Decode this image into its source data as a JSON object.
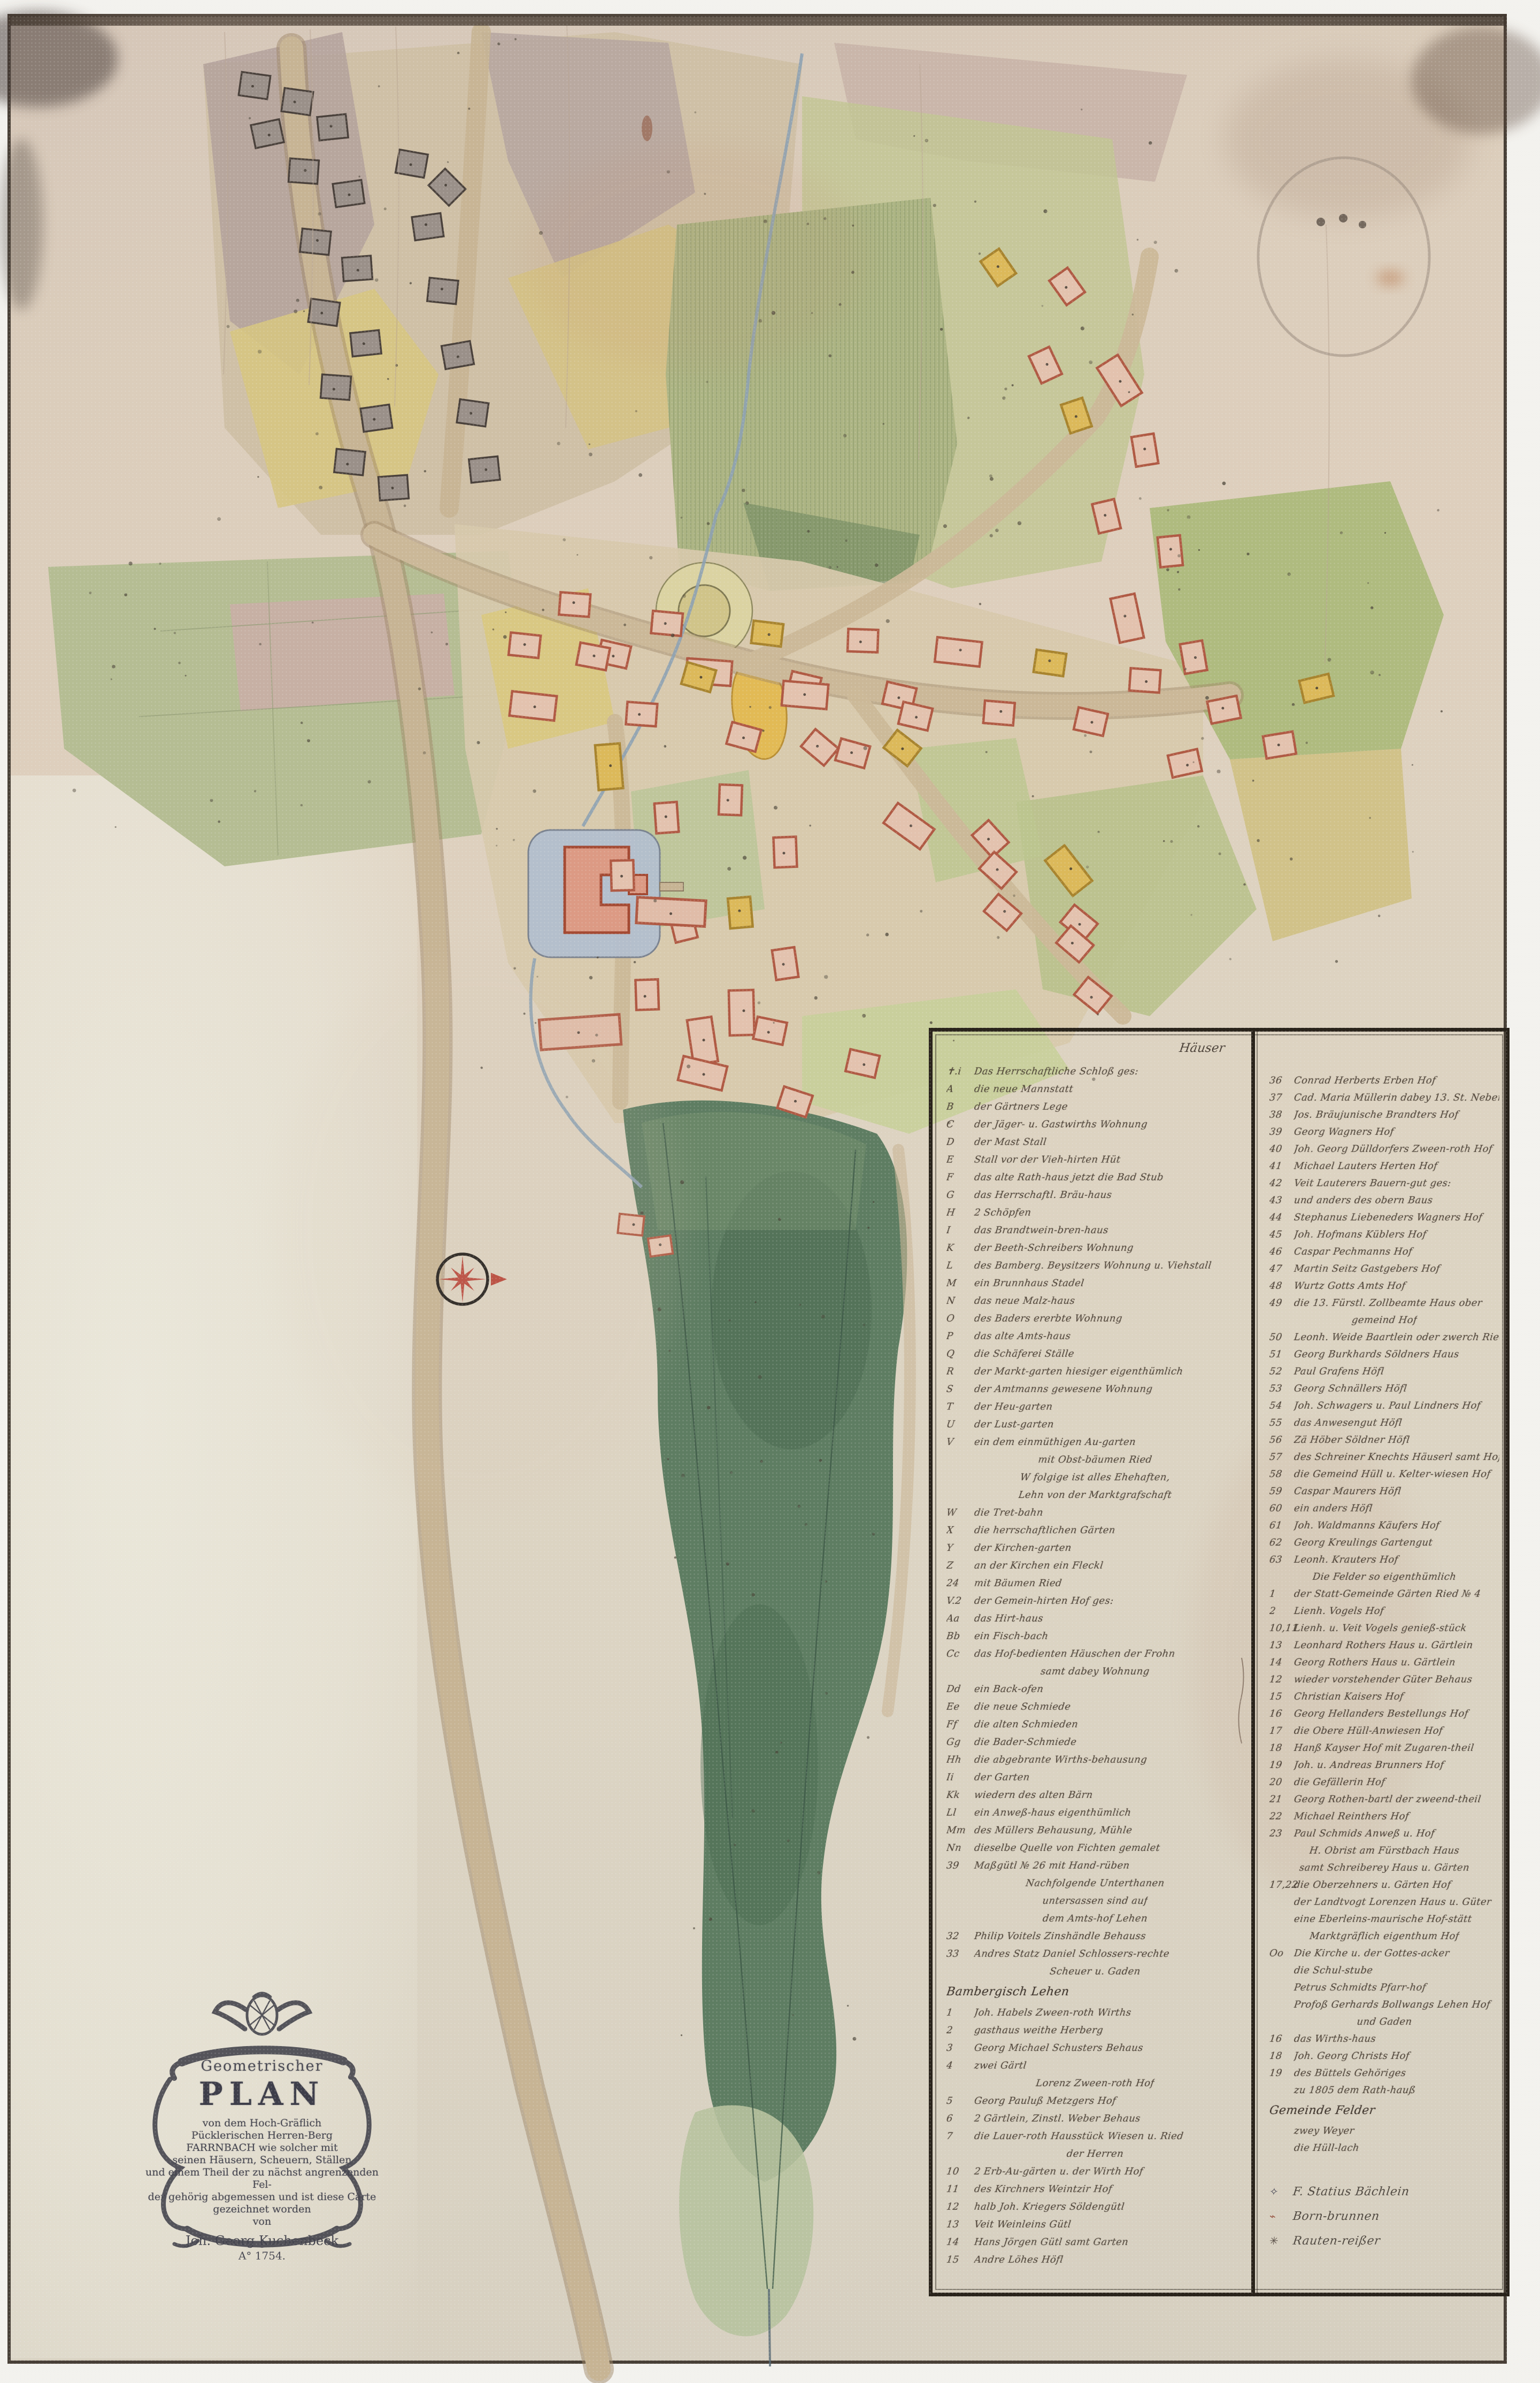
{
  "cartouche": {
    "kicker": "Geometrischer",
    "title": "PLAN",
    "lines": [
      "von dem Hoch-Gräflich",
      "Pücklerischen Herren-Berg",
      "FARRNBACH wie solcher mit",
      "seinen Häusern, Scheuern, Ställen",
      "und einem Theil der zu nächst angrenzenden Fel-",
      "der gehörig abgemessen und ist diese Carte",
      "gezeichnet worden",
      "von"
    ],
    "author": "Joh. Georg Kuchenbeck",
    "year": "A° 1754."
  },
  "legend": {
    "header_right": "Häuser",
    "col1": [
      {
        "k": "✝.i",
        "t": "Das Herrschaftliche Schloß ges:"
      },
      {
        "k": "A",
        "t": "die neue Mannstatt"
      },
      {
        "k": "B",
        "t": "der Gärtners Lege"
      },
      {
        "k": "C",
        "t": "der Jäger- u. Gastwirths Wohnung"
      },
      {
        "k": "D",
        "t": "der Mast Stall"
      },
      {
        "k": "E",
        "t": "Stall vor der Vieh-hirten Hüt"
      },
      {
        "k": "F",
        "t": "das alte Rath-haus jetzt die Bad Stub"
      },
      {
        "k": "G",
        "t": "das Herrschaftl. Bräu-haus"
      },
      {
        "k": "H",
        "t": "2 Schöpfen"
      },
      {
        "k": "I",
        "t": "das Brandtwein-bren-haus"
      },
      {
        "k": "K",
        "t": "der Beeth-Schreibers Wohnung"
      },
      {
        "k": "L",
        "t": "des Bamberg. Beysitzers Wohnung u. Viehstall"
      },
      {
        "k": "M",
        "t": "ein Brunnhaus Stadel"
      },
      {
        "k": "N",
        "t": "das neue Malz-haus"
      },
      {
        "k": "O",
        "t": "des Baders ererbte Wohnung"
      },
      {
        "k": "P",
        "t": "das alte Amts-haus"
      },
      {
        "k": "Q",
        "t": "die Schäferei Ställe"
      },
      {
        "k": "R",
        "t": "der Markt-garten hiesiger eigenthümlich"
      },
      {
        "k": "S",
        "t": "der Amtmanns gewesene Wohnung"
      },
      {
        "k": "T",
        "t": "der Heu-garten"
      },
      {
        "k": "U",
        "t": "der Lust-garten"
      },
      {
        "k": "V",
        "t": "ein dem einmüthigen Au-garten"
      },
      {
        "c": "mit Obst-bäumen Ried"
      },
      {
        "c": "W folgige ist alles Ehehaften,"
      },
      {
        "c": "Lehn von der Marktgrafschaft"
      },
      {
        "k": "W",
        "t": "die Tret-bahn"
      },
      {
        "k": "X",
        "t": "die herrschaftlichen Gärten"
      },
      {
        "k": "Y",
        "t": "der Kirchen-garten"
      },
      {
        "k": "Z",
        "t": "an der Kirchen ein Fleckl"
      },
      {
        "k": "24",
        "t": "mit Bäumen Ried"
      },
      {
        "k": "V.2",
        "t": "der Gemein-hirten Hof ges:"
      },
      {
        "k": "Aa",
        "t": "das Hirt-haus"
      },
      {
        "k": "Bb",
        "t": "ein Fisch-bach"
      },
      {
        "k": "Cc",
        "t": "das Hof-bedienten Häuschen der Frohn"
      },
      {
        "c": "samt dabey Wohnung"
      },
      {
        "k": "Dd",
        "t": "ein Back-ofen"
      },
      {
        "k": "Ee",
        "t": "die neue Schmiede"
      },
      {
        "k": "Ff",
        "t": "die alten Schmieden"
      },
      {
        "k": "Gg",
        "t": "die Bader-Schmiede"
      },
      {
        "k": "Hh",
        "t": "die abgebrante Wirths-behausung"
      },
      {
        "k": "Ii",
        "t": "der Garten"
      },
      {
        "k": "Kk",
        "t": "wiedern des alten Bärn"
      },
      {
        "k": "Ll",
        "t": "ein Anweß-haus eigenthümlich"
      },
      {
        "k": "Mm",
        "t": "des Müllers Behausung, Mühle"
      },
      {
        "k": "Nn",
        "t": "dieselbe Quelle von Fichten gemalet"
      },
      {
        "k": "39",
        "t": "Maßgütl № 26 mit Hand-rüben"
      },
      {
        "c": "Nachfolgende Unterthanen"
      },
      {
        "c": "untersassen sind auf"
      },
      {
        "c": "dem Amts-hof Lehen"
      },
      {
        "k": "32",
        "t": "Philip Voitels Zinshändle Behauss"
      },
      {
        "k": "33",
        "t": "Andres Statz Daniel Schlossers-rechte"
      },
      {
        "c": "Scheuer u. Gaden"
      },
      {
        "h": "Bambergisch Lehen"
      },
      {
        "k": "1",
        "t": "Joh. Habels Zween-roth Wirths"
      },
      {
        "k": "2",
        "t": "gasthaus weithe Herberg"
      },
      {
        "k": "3",
        "t": "Georg Michael Schusters Behaus"
      },
      {
        "k": "4",
        "t": "zwei Gärtl"
      },
      {
        "c": "Lorenz Zween-roth Hof"
      },
      {
        "k": "5",
        "t": "Georg Pauluß Metzgers Hof"
      },
      {
        "k": "6",
        "t": "2 Gärtlein, Zinstl. Weber Behaus"
      },
      {
        "k": "7",
        "t": "die Lauer-roth Hausstück Wiesen u. Ried"
      },
      {
        "c": "der Herren"
      },
      {
        "k": "10",
        "t": "2 Erb-Au-gärten u. der Wirth Hof"
      },
      {
        "k": "11",
        "t": "des Kirchners Weintzir Hof"
      },
      {
        "k": "12",
        "t": "halb Joh. Kriegers Söldengütl"
      },
      {
        "k": "13",
        "t": "Veit Weinleins Gütl"
      },
      {
        "k": "14",
        "t": "Hans Jörgen Gütl samt Garten"
      },
      {
        "k": "15",
        "t": "Andre Löhes Höfl"
      }
    ],
    "col2": [
      {
        "k": "36",
        "t": "Conrad Herberts Erben Hof"
      },
      {
        "k": "37",
        "t": "Cad. Maria Müllerin dabey 13. St. Nebenbau"
      },
      {
        "k": "38",
        "t": "Jos. Bräujunische Brandters Hof"
      },
      {
        "k": "39",
        "t": "Georg Wagners Hof"
      },
      {
        "k": "40",
        "t": "Joh. Georg Dülldorfers Zween-roth Hof"
      },
      {
        "k": "41",
        "t": "Michael Lauters Herten Hof"
      },
      {
        "k": "42",
        "t": "Veit Lauterers Bauern-gut ges:"
      },
      {
        "k": "43",
        "t": "und anders des obern Baus"
      },
      {
        "k": "44",
        "t": "Stephanus Liebeneders Wagners Hof"
      },
      {
        "k": "45",
        "t": "Joh. Hofmans Küblers Hof"
      },
      {
        "k": "46",
        "t": "Caspar Pechmanns Hof"
      },
      {
        "k": "47",
        "t": "Martin Seitz Gastgebers Hof"
      },
      {
        "k": "48",
        "t": "Wurtz Gotts Amts Hof"
      },
      {
        "k": "49",
        "t": "die 13. Fürstl. Zollbeamte Haus ober"
      },
      {
        "c": "gemeind Hof"
      },
      {
        "k": "50",
        "t": "Leonh. Weide Baartlein oder zwerch Ried"
      },
      {
        "k": "51",
        "t": "Georg Burkhards Söldners Haus"
      },
      {
        "k": "52",
        "t": "Paul Grafens Höfl"
      },
      {
        "k": "53",
        "t": "Georg Schnällers Höfl"
      },
      {
        "k": "54",
        "t": "Joh. Schwagers u. Paul Lindners Hof"
      },
      {
        "k": "55",
        "t": "das Anwesengut Höfl"
      },
      {
        "k": "56",
        "t": "Zä Höber Söldner Höfl"
      },
      {
        "k": "57",
        "t": "des Schreiner Knechts Häuserl samt Hof"
      },
      {
        "k": "58",
        "t": "die Gemeind Hüll u. Kelter-wiesen Hof"
      },
      {
        "k": "59",
        "t": "Caspar Maurers Höfl"
      },
      {
        "k": "60",
        "t": "ein anders Höfl"
      },
      {
        "k": "61",
        "t": "Joh. Waldmanns Käufers Hof"
      },
      {
        "k": "62",
        "t": "Georg Kreulings Gartengut"
      },
      {
        "k": "63",
        "t": "Leonh. Krauters Hof"
      },
      {
        "c": "Die Felder so eigenthümlich"
      },
      {
        "k": "1",
        "t": "der Statt-Gemeinde Gärten Ried № 4"
      },
      {
        "k": "2",
        "t": "Lienh. Vogels Hof"
      },
      {
        "k": "10,11",
        "t": "Lienh. u. Veit Vogels genieß-stück"
      },
      {
        "k": "13",
        "t": "Leonhard Rothers Haus u. Gärtlein"
      },
      {
        "k": "14",
        "t": "Georg Rothers Haus u. Gärtlein"
      },
      {
        "k": "12",
        "t": "wieder vorstehender Güter Behaus"
      },
      {
        "k": "15",
        "t": "Christian Kaisers Hof"
      },
      {
        "k": "16",
        "t": "Georg Hellanders Bestellungs Hof"
      },
      {
        "k": "17",
        "t": "die Obere Hüll-Anwiesen Hof"
      },
      {
        "k": "18",
        "t": "Hanß Kayser Hof mit Zugaren-theil"
      },
      {
        "k": "19",
        "t": "Joh. u. Andreas Brunners Hof"
      },
      {
        "k": "20",
        "t": "die Gefällerin Hof"
      },
      {
        "k": "21",
        "t": "Georg Rothen-bartl der zweend-theil"
      },
      {
        "k": "22",
        "t": "Michael Reinthers Hof"
      },
      {
        "k": "23",
        "t": "Paul Schmids Anweß u. Hof"
      },
      {
        "c": "H. Obrist am Fürstbach Haus"
      },
      {
        "c": "samt Schreiberey Haus u. Gärten"
      },
      {
        "k": "17,22",
        "t": "die Oberzehners u. Gärten Hof"
      },
      {
        "k": "",
        "t": "der Landtvogt Lorenzen Haus u. Güter"
      },
      {
        "k": "",
        "t": "eine Eberleins-maurische Hof-stätt"
      },
      {
        "c": "Marktgräflich eigenthum Hof"
      },
      {
        "k": "Oo",
        "t": "Die Kirche u. der Gottes-acker"
      },
      {
        "k": "",
        "t": "die Schul-stube"
      },
      {
        "k": "",
        "t": "Petrus Schmidts Pfarr-hof"
      },
      {
        "k": "",
        "t": "Profoß Gerhards Bollwangs Lehen Hof"
      },
      {
        "c": "und Gaden"
      },
      {
        "k": "16",
        "t": "das Wirths-haus"
      },
      {
        "k": "18",
        "t": "Joh. Georg Christs Hof"
      },
      {
        "k": "19",
        "t": "des Büttels Gehöriges"
      },
      {
        "k": "",
        "t": "zu 1805 dem Rath-hauß"
      },
      {
        "h": "Gemeinde Felder"
      },
      {
        "k": "",
        "t": "zwey Weyer"
      },
      {
        "k": "",
        "t": "die Hüll-lach"
      }
    ],
    "symbols": [
      {
        "mark": "✧",
        "color": "#4a4a58",
        "t": "F. Statius Bächlein"
      },
      {
        "mark": "⌁",
        "color": "#9a5a48",
        "t": "Born-brunnen"
      },
      {
        "mark": "✳",
        "color": "#554a42",
        "t": "Rauten-reißer"
      }
    ]
  },
  "palette": {
    "paper": "#dcd2bf",
    "paper_light": "#e9e6d8",
    "field_green": "#aeb886",
    "field_yellow": "#d6c482",
    "field_mauve": "#b4a29c",
    "meadow_dark_green": "#5e7d62",
    "building_red": "#b05a44",
    "building_grey": "#8f857d",
    "moat_blue": "#b3bfce",
    "road_tan": "#c7b494",
    "ink": "#3a332c",
    "compass_red": "#b5372b"
  }
}
